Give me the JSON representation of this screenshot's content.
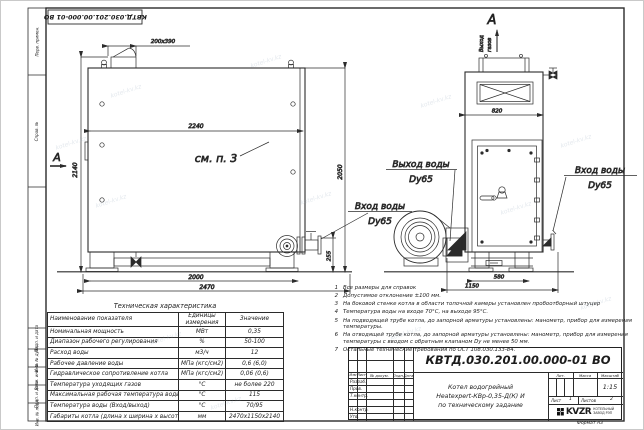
{
  "watermark": "kotel-kv.kz",
  "frame": {
    "stamp_number": "КВТД.030.201.00.000-01 ВО",
    "format_label": "Формат  А3",
    "side_labels": [
      "Перв. примен.",
      "Справ. №",
      "Подп. и дата",
      "Инв. № дубл.",
      "Взам. инв. №",
      "Подп. и дата",
      "Инв. № подл."
    ]
  },
  "drawing": {
    "side_view": {
      "section_letter": "А",
      "see_note": "см. п. 3",
      "dim_chimney": "200х390",
      "dim_width_inner": "2240",
      "dim_height_total": "2140",
      "dim_height_body": "2050",
      "dim_support_span": "2000",
      "dim_length": "2470",
      "dim_inlet_height": "255"
    },
    "front_view": {
      "section_letter": "А",
      "gas_outlet_line1": "Выход",
      "gas_outlet_line2": "газов",
      "dim_body_width": "820",
      "dim_support_span": "580",
      "dim_width": "1150"
    },
    "labels": {
      "water_outlet": "Выход воды",
      "water_outlet_dn": "Dy65",
      "water_inlet": "Вход воды",
      "water_inlet_dn": "Dy65",
      "water_inlet2": "Вход воды",
      "water_inlet2_dn": "Dy65"
    }
  },
  "notes": {
    "items": [
      {
        "n": "1",
        "text": "Все размеры для справок"
      },
      {
        "n": "2",
        "text": "Допустимое отклонение ±100 мм."
      },
      {
        "n": "3",
        "text": "На боковой стенке котла в области топочной камеры установлен пробоотборный штуцер"
      },
      {
        "n": "4",
        "text": "Температура воды на входе 70°С, на выходе 95°С."
      },
      {
        "n": "5",
        "text": "На подводящей трубе котла, до запорной арматуры установлены: манометр, прибор для измерения температуры."
      },
      {
        "n": "6",
        "text": "На отводящей трубе котла, до запорной арматуры установлены: манометр, прибор для измерения температуры с вводом с обратным клапаном Dу не менее 50 мм."
      },
      {
        "n": "7",
        "text": "Остальные технические требования по ОСТ 108.030.133-84."
      }
    ]
  },
  "tech_table": {
    "title": "Техническая характеристика",
    "col_name": "Наименование показателя",
    "col_unit": "Единицы измерения",
    "col_value": "Значение",
    "rows": [
      {
        "name": "Номинальная мощность",
        "unit": "МВт",
        "value": "0,35"
      },
      {
        "name": "Диапазон рабочего регулирования",
        "unit": "%",
        "value": "50-100"
      },
      {
        "name": "Расход воды",
        "unit": "м3/ч",
        "value": "12"
      },
      {
        "name": "Рабочее давление воды",
        "unit": "МПа (кгс/см2)",
        "value": "0,6 (6,0)"
      },
      {
        "name": "Гидравлическое сопротивление котла",
        "unit": "МПа (кгс/см2)",
        "value": "0,06 (0,6)"
      },
      {
        "name": "Температура уходящих газов",
        "unit": "°С",
        "value": "не более 220"
      },
      {
        "name": "Максимальная рабочая температура воды",
        "unit": "°С",
        "value": "115"
      },
      {
        "name": "Температура воды (Вход/выход)",
        "unit": "°С",
        "value": "70/95"
      },
      {
        "name": "Габариты котла (длина х ширина х высота)",
        "unit": "мм",
        "value": "2470х1150х2140"
      }
    ]
  },
  "title_block": {
    "doc_number": "КВТД.030.201.00.000-01 ВО",
    "title_line1": "Котел водогрейный",
    "title_line2": "Heatexpert-КВр-0,35-Д(К) И",
    "title_line3": "по техническому задание",
    "hdr_izm": "Изм",
    "hdr_list": "Лист",
    "hdr_doc": "№ докум.",
    "hdr_podp": "Подп.",
    "hdr_data": "Дата",
    "row_razrab": "Разраб.",
    "row_prov": "Пров.",
    "row_tkontr": "Т.контр.",
    "row_nkontr": "Н.контр.",
    "row_utv": "Утв.",
    "hdr_lit": "Лит.",
    "hdr_massa": "Масса",
    "hdr_masshtab": "Масштаб",
    "scale": "1:15",
    "sheet_label": "Лист",
    "sheet_num": "1",
    "sheets_label": "Листов",
    "sheets_num": "2",
    "logo_text": "KVZR",
    "logo_line1": "КОТЕЛЬНЫЙ",
    "logo_line2": "ЗАВОД РЭП"
  }
}
